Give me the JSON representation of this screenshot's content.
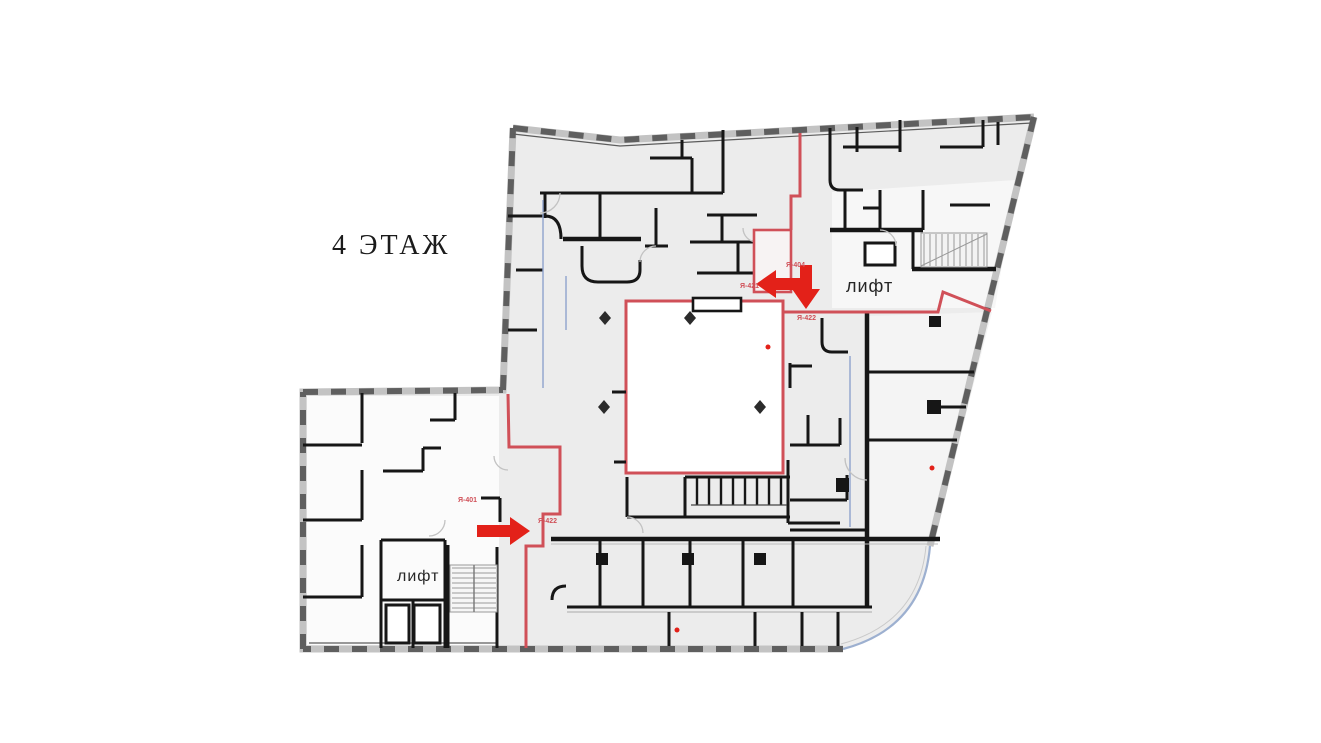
{
  "floor_plan": {
    "floor_label": "4 ЭТАЖ",
    "elevator_label_upper": "лифт",
    "elevator_label_lower": "лифт",
    "room_tags": [
      {
        "label": "Я-404",
        "location": "above-left-arrow"
      },
      {
        "label": "Я-421",
        "location": "left-of-left-arrow"
      },
      {
        "label": "Я-422",
        "location": "below-down-arrow"
      },
      {
        "label": "Я-401",
        "location": "above-right-arrow"
      },
      {
        "label": "Я-422",
        "location": "right-of-right-arrow"
      }
    ],
    "route_markers": [
      {
        "icon": "arrow-left-icon",
        "direction": "left",
        "area": "upper-center near elevator lobby"
      },
      {
        "icon": "arrow-down-icon",
        "direction": "down",
        "area": "upper-center near elevator lobby"
      },
      {
        "icon": "arrow-right-icon",
        "direction": "right",
        "area": "lower-left wing near elevator"
      }
    ],
    "features": {
      "courtyard": "central white shaft outlined in red",
      "stairs_upper_right": "staircase with treads",
      "stairs_lower_left": "staircase with treads",
      "elevator_shafts_lower_left": 2
    },
    "colors": {
      "highlight_red": "#d05058",
      "arrow_red": "#e32119",
      "wall_black": "#161616",
      "hatch_gray": "#5f5f5f",
      "floor_gray": "#ececec",
      "window_blue": "#8fa3cc",
      "background": "#ffffff"
    }
  }
}
